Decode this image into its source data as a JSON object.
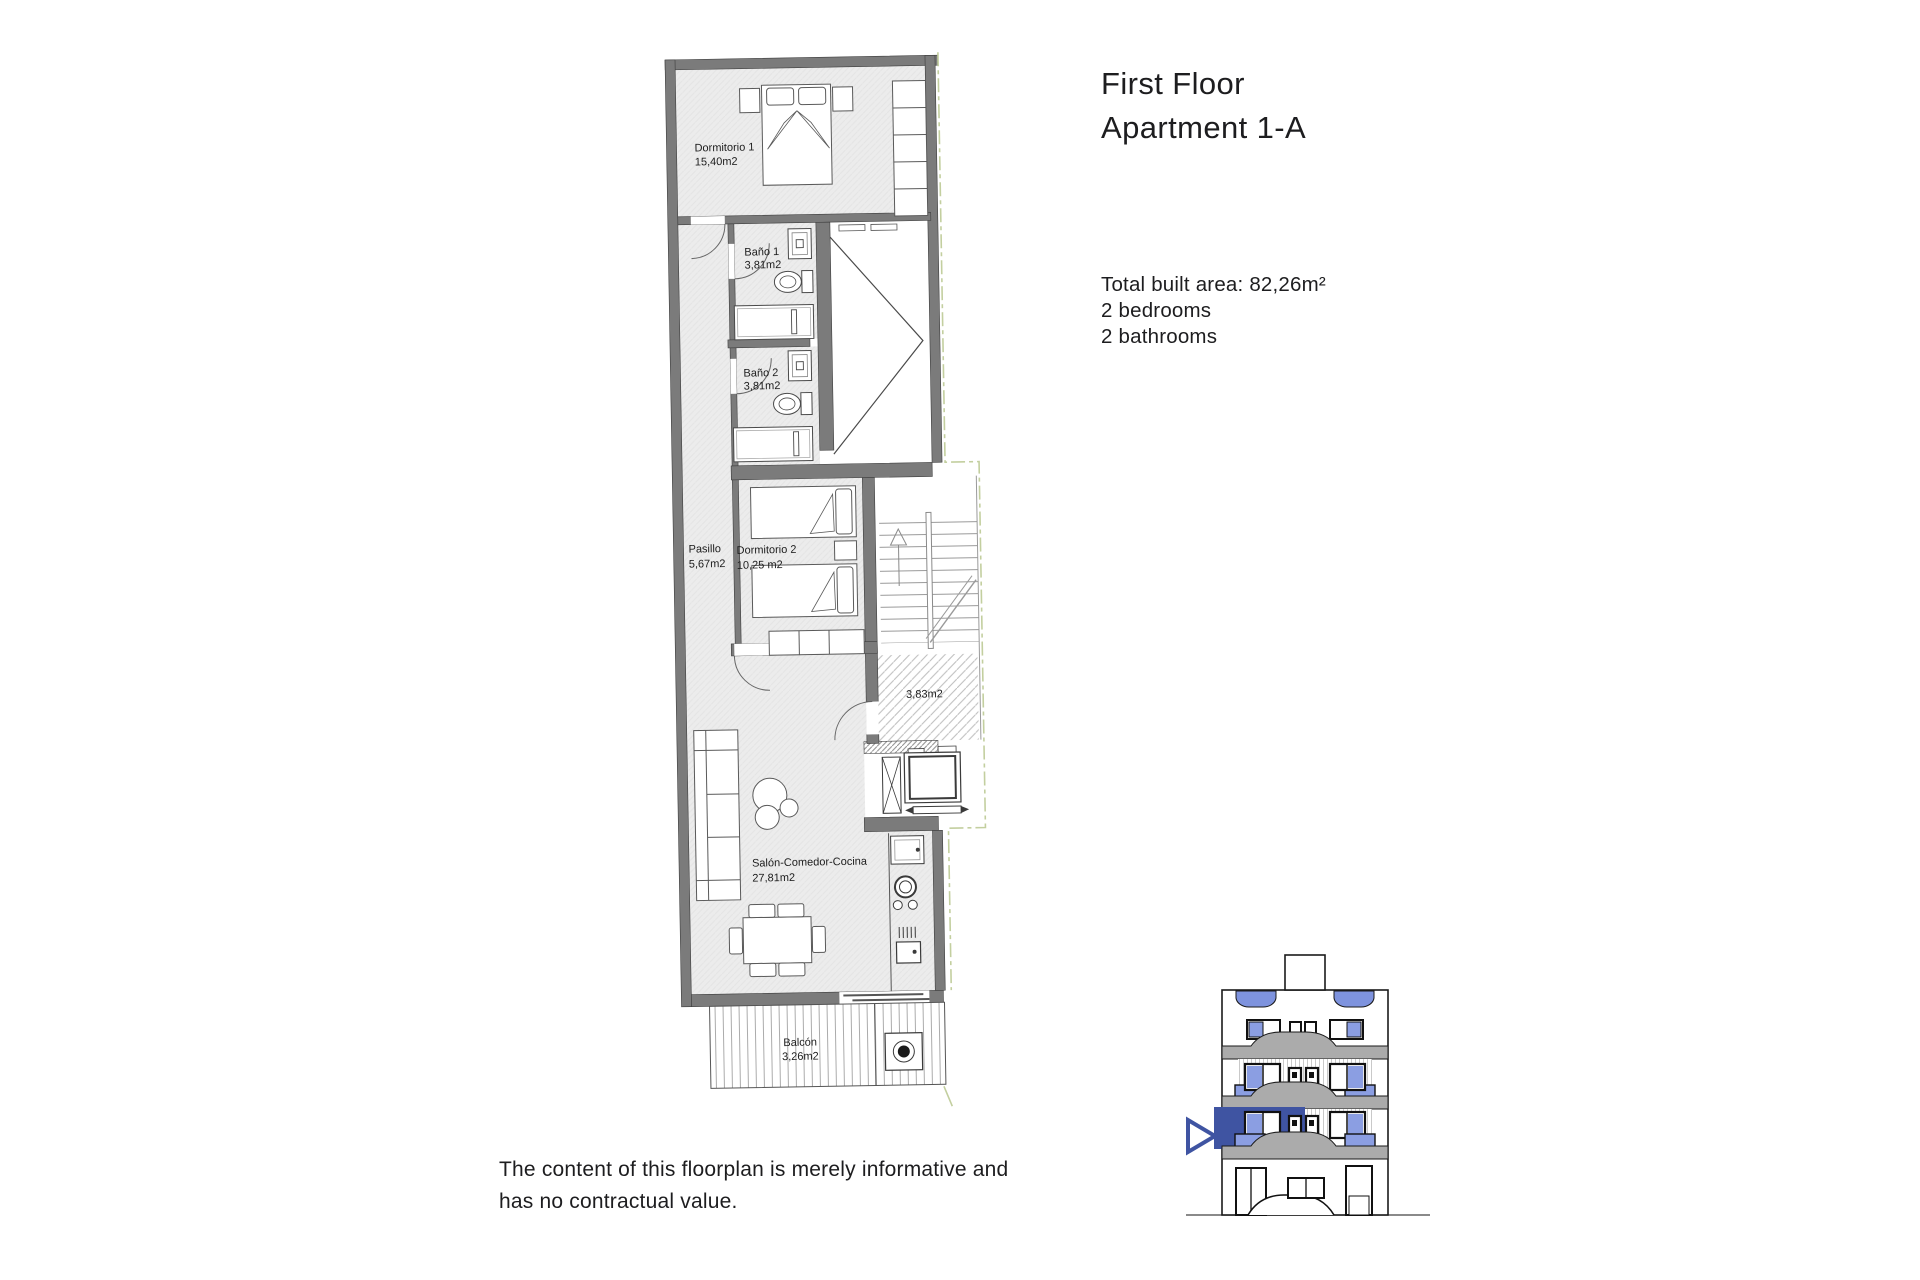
{
  "header": {
    "title_line1": "First Floor",
    "title_line2": "Apartment 1-A"
  },
  "summary": {
    "total_area": "Total built area: 82,26m²",
    "bedrooms": "2 bedrooms",
    "bathrooms": "2 bathrooms"
  },
  "disclaimer": {
    "line1": "The content of this floorplan is merely informative and",
    "line2": "has no contractual value."
  },
  "floorplan": {
    "rooms": {
      "dormitorio1": {
        "name": "Dormitorio 1",
        "area": "15,40m2"
      },
      "bano1": {
        "name": "Baño 1",
        "area": "3,81m2"
      },
      "bano2": {
        "name": "Baño 2",
        "area": "3,81m2"
      },
      "pasillo": {
        "name": "Pasillo",
        "area": "5,67m2"
      },
      "dormitorio2": {
        "name": "Dormitorio 2",
        "area": "10,25 m2"
      },
      "terraza": {
        "name": "",
        "area": "3,83m2"
      },
      "salon": {
        "name": "Salón-Comedor-Cocina",
        "area": "27,81m2"
      },
      "balcon": {
        "name": "Balcón",
        "area": "3,26m2"
      }
    }
  },
  "colors": {
    "wall_gray": "#7b7b7b",
    "floor_gray": "#ececec",
    "accent_blue": "#3f54a2",
    "pane_blue": "#8b9ee2",
    "boundary_green": "#c3cf9f",
    "text": "#1d1d1f"
  }
}
